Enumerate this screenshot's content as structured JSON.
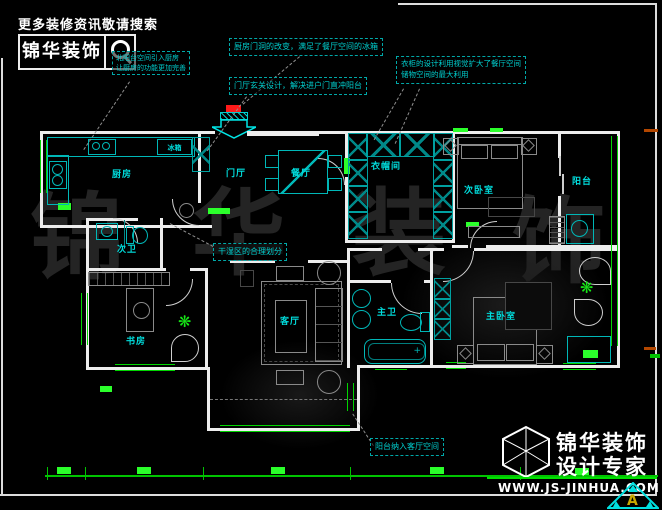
{
  "colors": {
    "background": "#000000",
    "wall": "#ededed",
    "fixture_cyan": "#00b7b7",
    "window_green": "#00d400",
    "sill_green": "#2bff2b",
    "label_cyan": "#00dcdc",
    "entry_red": "#ff1a1a",
    "brand_white": "#ffffff",
    "watermark_gray": "#242424",
    "triangle_logo_cyan": "#00e0e0",
    "logo_a_yellow": "#c8a800"
  },
  "header": {
    "slogan": "更多装修资讯敬请搜索",
    "brand": "锦华装饰",
    "search_icon": "magnifier",
    "note_line1": "北阳台空间引入厨房",
    "note_line2": "让厨房的功能更加完善"
  },
  "annotations": [
    {
      "text": "厨房门洞的改变，满足了餐厅空间的冰箱"
    },
    {
      "text": "门厅玄关设计，解决进户门直冲阳台"
    },
    {
      "line1": "衣柜的设计利用视觉扩大了餐厅空间",
      "line2": "储物空间的最大利用"
    },
    {
      "text": "干湿区的合理划分"
    },
    {
      "text": "阳台纳入客厅空间"
    }
  ],
  "rooms": [
    {
      "id": "kitchen",
      "label": "厨房"
    },
    {
      "id": "fridge",
      "label": "冰箱"
    },
    {
      "id": "entry-hall",
      "label": "门厅"
    },
    {
      "id": "dining",
      "label": "餐厅"
    },
    {
      "id": "cloakroom",
      "label": "衣帽间"
    },
    {
      "id": "second-bedroom",
      "label": "次卧室"
    },
    {
      "id": "east-balcony",
      "label": "阳台"
    },
    {
      "id": "second-bathroom",
      "label": "次卫"
    },
    {
      "id": "study",
      "label": "书房"
    },
    {
      "id": "living-room",
      "label": "客厅"
    },
    {
      "id": "master-bathroom",
      "label": "主卫"
    },
    {
      "id": "master-bedroom",
      "label": "主卧室"
    }
  ],
  "watermark": {
    "char1": "锦",
    "char2": "华",
    "char3": "装",
    "char4": "饰"
  },
  "footer": {
    "logo": "cube-wireframe",
    "brand_line1": "锦华装饰",
    "brand_line2": "设计专家",
    "website": "WWW.JS-JINHUA.COM",
    "corner_logo_letter": "A"
  }
}
